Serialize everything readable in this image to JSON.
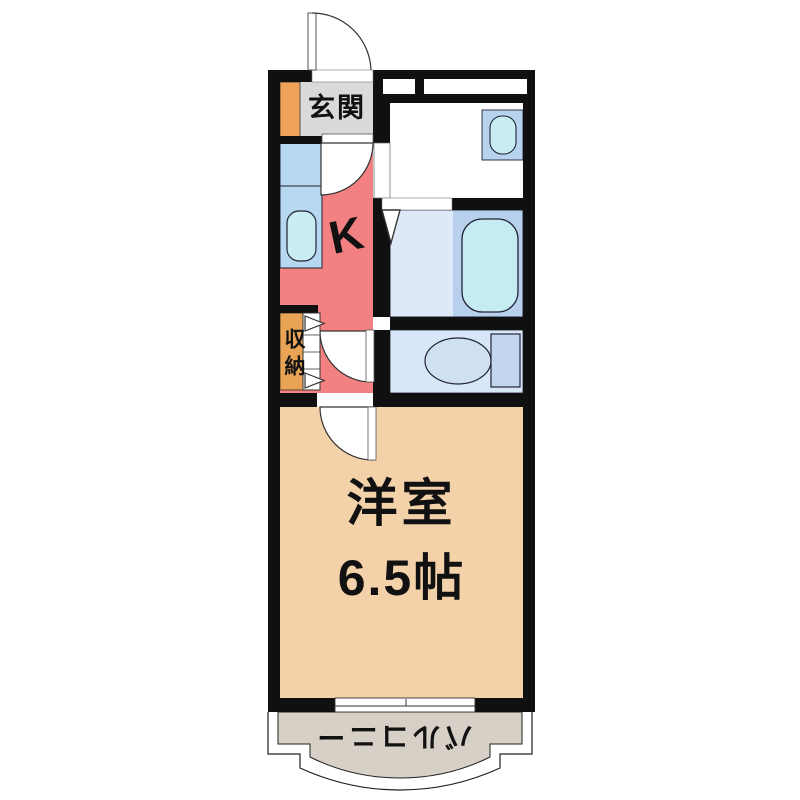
{
  "floorplan": {
    "rooms": {
      "genkan": {
        "label": "玄関"
      },
      "kitchen": {
        "label": "K"
      },
      "storage": {
        "label": "収納"
      },
      "western_room": {
        "label": "洋室",
        "size": "6.5帖"
      },
      "balcony": {
        "label": "バルコニー"
      }
    },
    "colors": {
      "wall": "#101010",
      "genkan": "#dadada",
      "shoe_cabinet": "#efa257",
      "kitchen": "#f38181",
      "kitchen_counter": "#b7d8f1",
      "sink": "#c7edf2",
      "storage": "#e8a355",
      "washroom": "#ffffff",
      "wash_basin": "#b7d3ee",
      "bathroom_left": "#dde9f7",
      "bathroom_right": "#b7d1ed",
      "bathtub": "#c4ecf2",
      "toilet_room": "#d8e7f7",
      "toilet_tank": "#c2d6ef",
      "western_room": "#f3d1a9",
      "balcony": "#d6d0c7"
    }
  }
}
